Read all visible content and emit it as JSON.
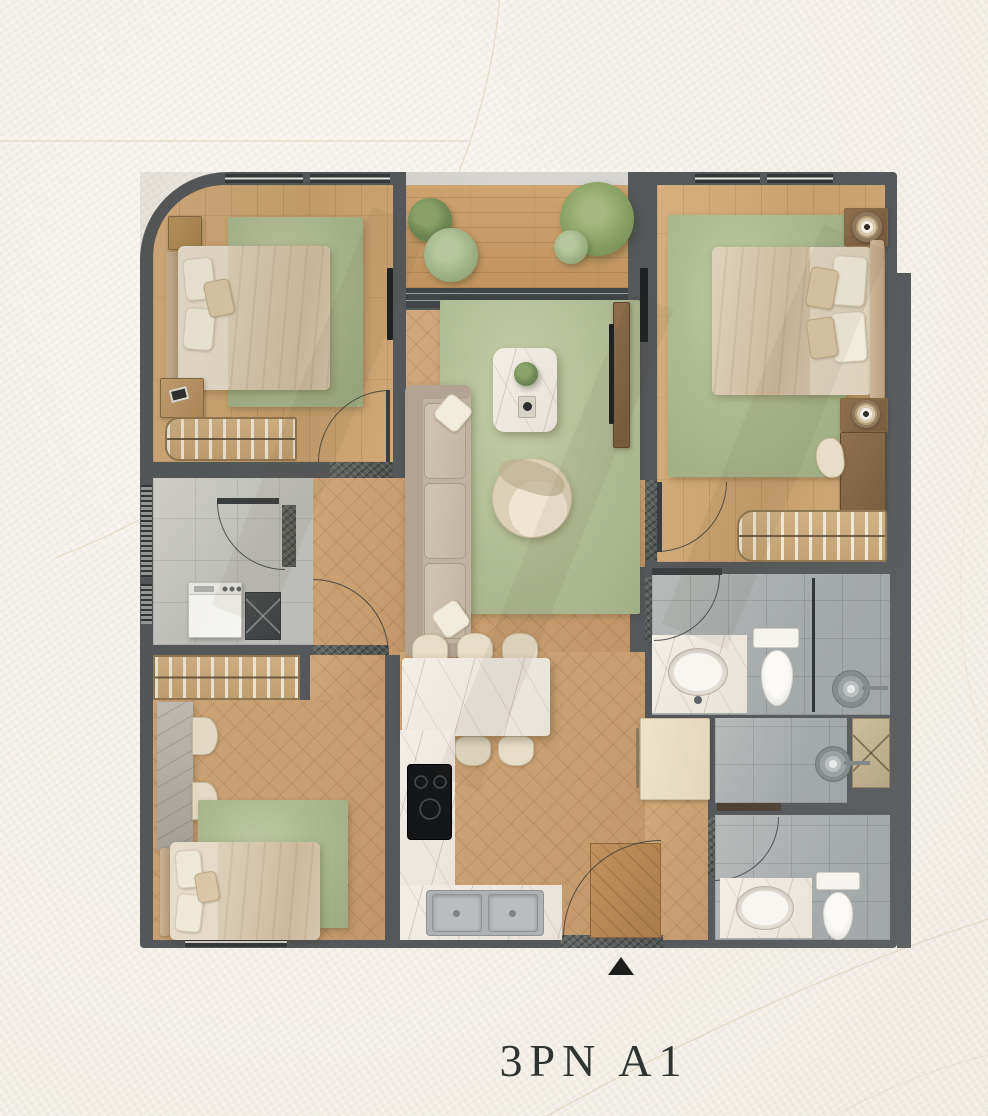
{
  "title": {
    "label": "3PN A1"
  },
  "plan": {
    "name": "apartment-floor-plan-3pn-a1",
    "entry_marker": "triangle-up"
  },
  "palette": {
    "background": "#f3efe8",
    "wall": "#54585b",
    "wood_light": "#d1a876",
    "wood_herringbone": "#c79d6f",
    "rug_green": "#a9b78c",
    "marble_white": "#eee8de",
    "utility_tile": "#c6c7c3",
    "bathroom_tile": "#a8acad",
    "linen_beige": "#e2d6c2",
    "fixture_white": "#f8f6f1",
    "appliance_black": "#141617",
    "decor_line": "#d8c8a4",
    "title_text": "#2e3432"
  }
}
